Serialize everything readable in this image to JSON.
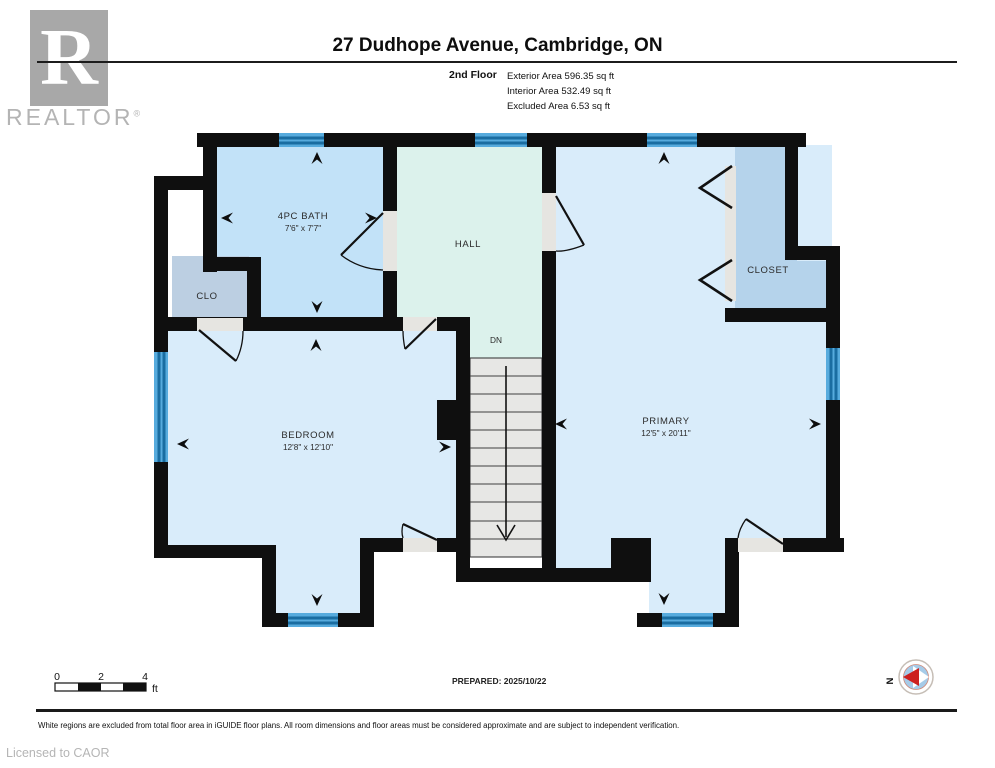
{
  "header": {
    "logo_r": "R",
    "logo_text": "REALTOR",
    "logo_reg": "®",
    "title": "27 Dudhope Avenue, Cambridge, ON",
    "floor_label": "2nd Floor",
    "areas": [
      "Exterior Area 596.35 sq ft",
      "Interior Area 532.49 sq ft",
      "Excluded Area 6.53 sq ft"
    ]
  },
  "rooms": {
    "bath": {
      "name": "4PC BATH",
      "dims": "7'6\" x 7'7\""
    },
    "hall": {
      "name": "HALL"
    },
    "clo": {
      "name": "CLO"
    },
    "closet": {
      "name": "CLOSET"
    },
    "bedroom": {
      "name": "BEDROOM",
      "dims": "12'8\" x 12'10\""
    },
    "primary": {
      "name": "PRIMARY",
      "dims": "12'5\" x 20'11\""
    },
    "stairs": {
      "dn": "DN"
    }
  },
  "footer": {
    "scale": {
      "t0": "0",
      "t1": "2",
      "t2": "4",
      "unit": "ft"
    },
    "prepared": "PREPARED: 2025/10/22",
    "compass_n": "N",
    "disclaimer": "White regions are excluded from total floor area in iGUIDE floor plans. All room dimensions and floor areas must be considered approximate and are subject to independent verification.",
    "license": "Licensed to CAOR"
  },
  "colors": {
    "wall": "#0f0f0f",
    "bath_fill": "#c2e2f8",
    "bedroom_fill": "#d9ecfa",
    "hall_fill": "#dcf2ec",
    "closet_fill": "#b5d3eb",
    "window_blue": "#57abdd",
    "compass_red": "#cc2020",
    "logo_grey": "#a8a8a8"
  }
}
